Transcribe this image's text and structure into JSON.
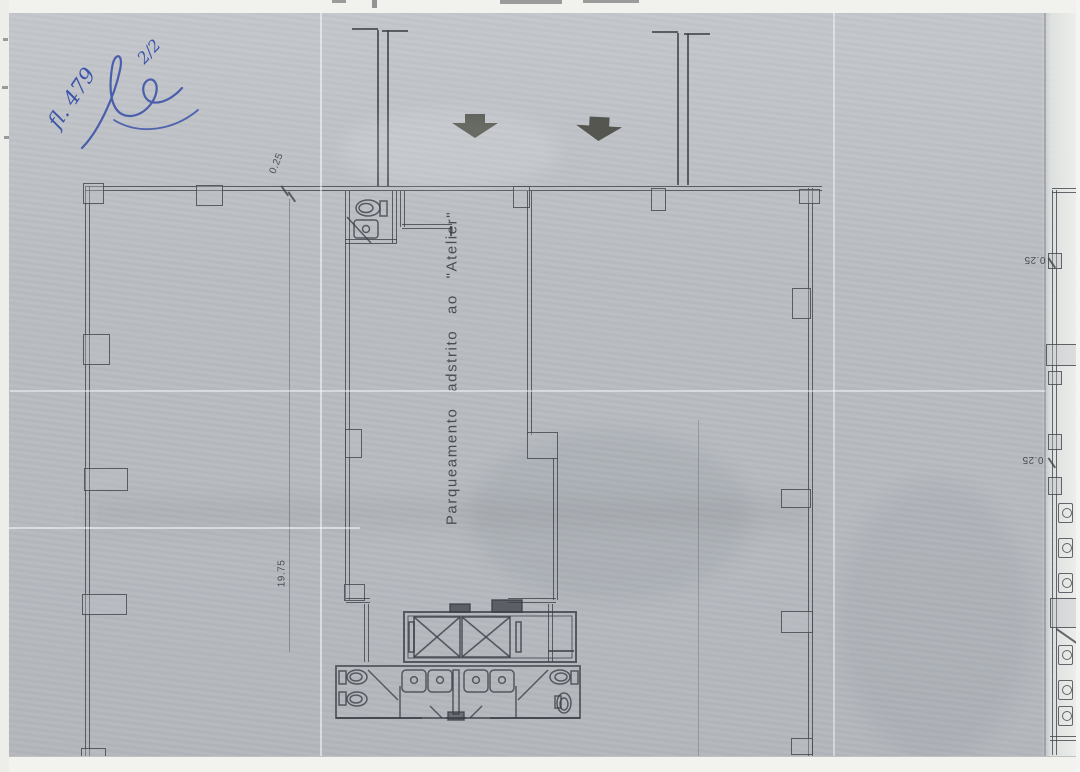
{
  "scan": {
    "handwriting": {
      "folio": "fl. 479",
      "fraction": "2/2"
    },
    "main_plan": {
      "room_label": "Parqueamento adstrito ao \"Atelier\"",
      "dim_offset": "0.25",
      "dim_length": "19.75"
    },
    "adjacent_plan": {
      "dim_offset_upper": "0.25",
      "dim_offset_lower": "0.25"
    },
    "icons": {
      "entrance_arrow": "down-arrow",
      "toilet": "oval-bowl-with-tank",
      "sink": "basin-with-drain",
      "elevator": "crossed-box-pair"
    },
    "colors": {
      "paper": "#bdc1c6",
      "drawing_line": "#3e4048",
      "handwriting_ink": "#3d53a8",
      "arrow_fill": "#4b4d44",
      "scan_margin": "#f1f1ee"
    }
  }
}
